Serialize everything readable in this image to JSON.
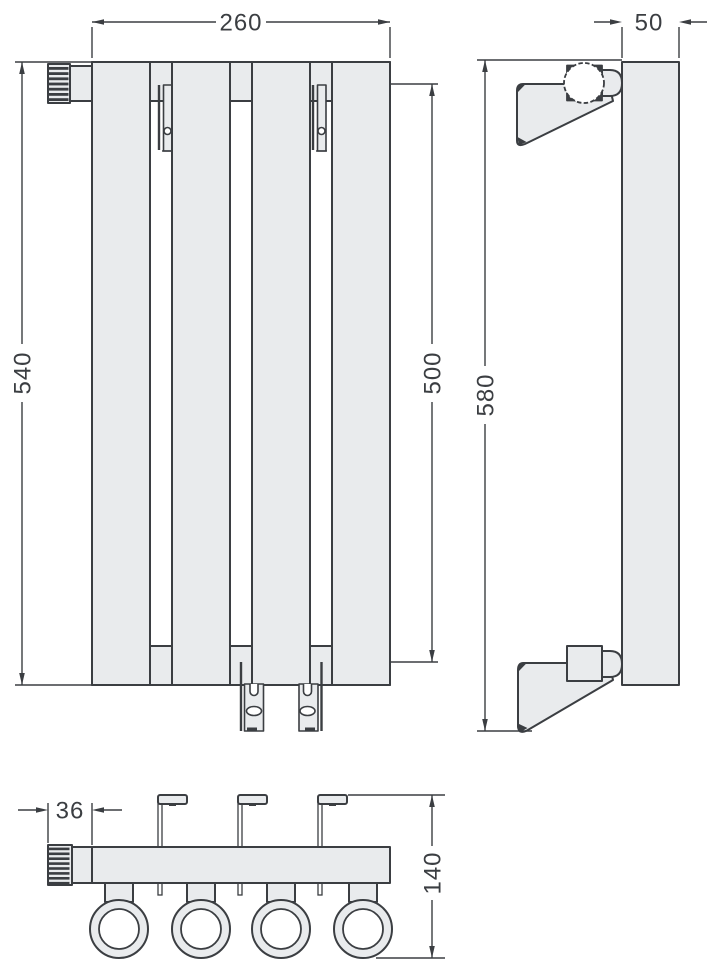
{
  "page": {
    "background": "#ffffff"
  },
  "drawing": {
    "line_color": "#3b3e42",
    "fill_color": "#e9ebed",
    "views": {
      "front": {
        "name": "front view",
        "dims": {
          "width": "260",
          "height": "540",
          "connection_span": "500"
        }
      },
      "side": {
        "name": "side view",
        "dims": {
          "depth": "50",
          "height": "580"
        }
      },
      "bottom": {
        "name": "bottom view",
        "dims": {
          "valve_offset": "36",
          "depth_overall": "140"
        }
      }
    }
  }
}
